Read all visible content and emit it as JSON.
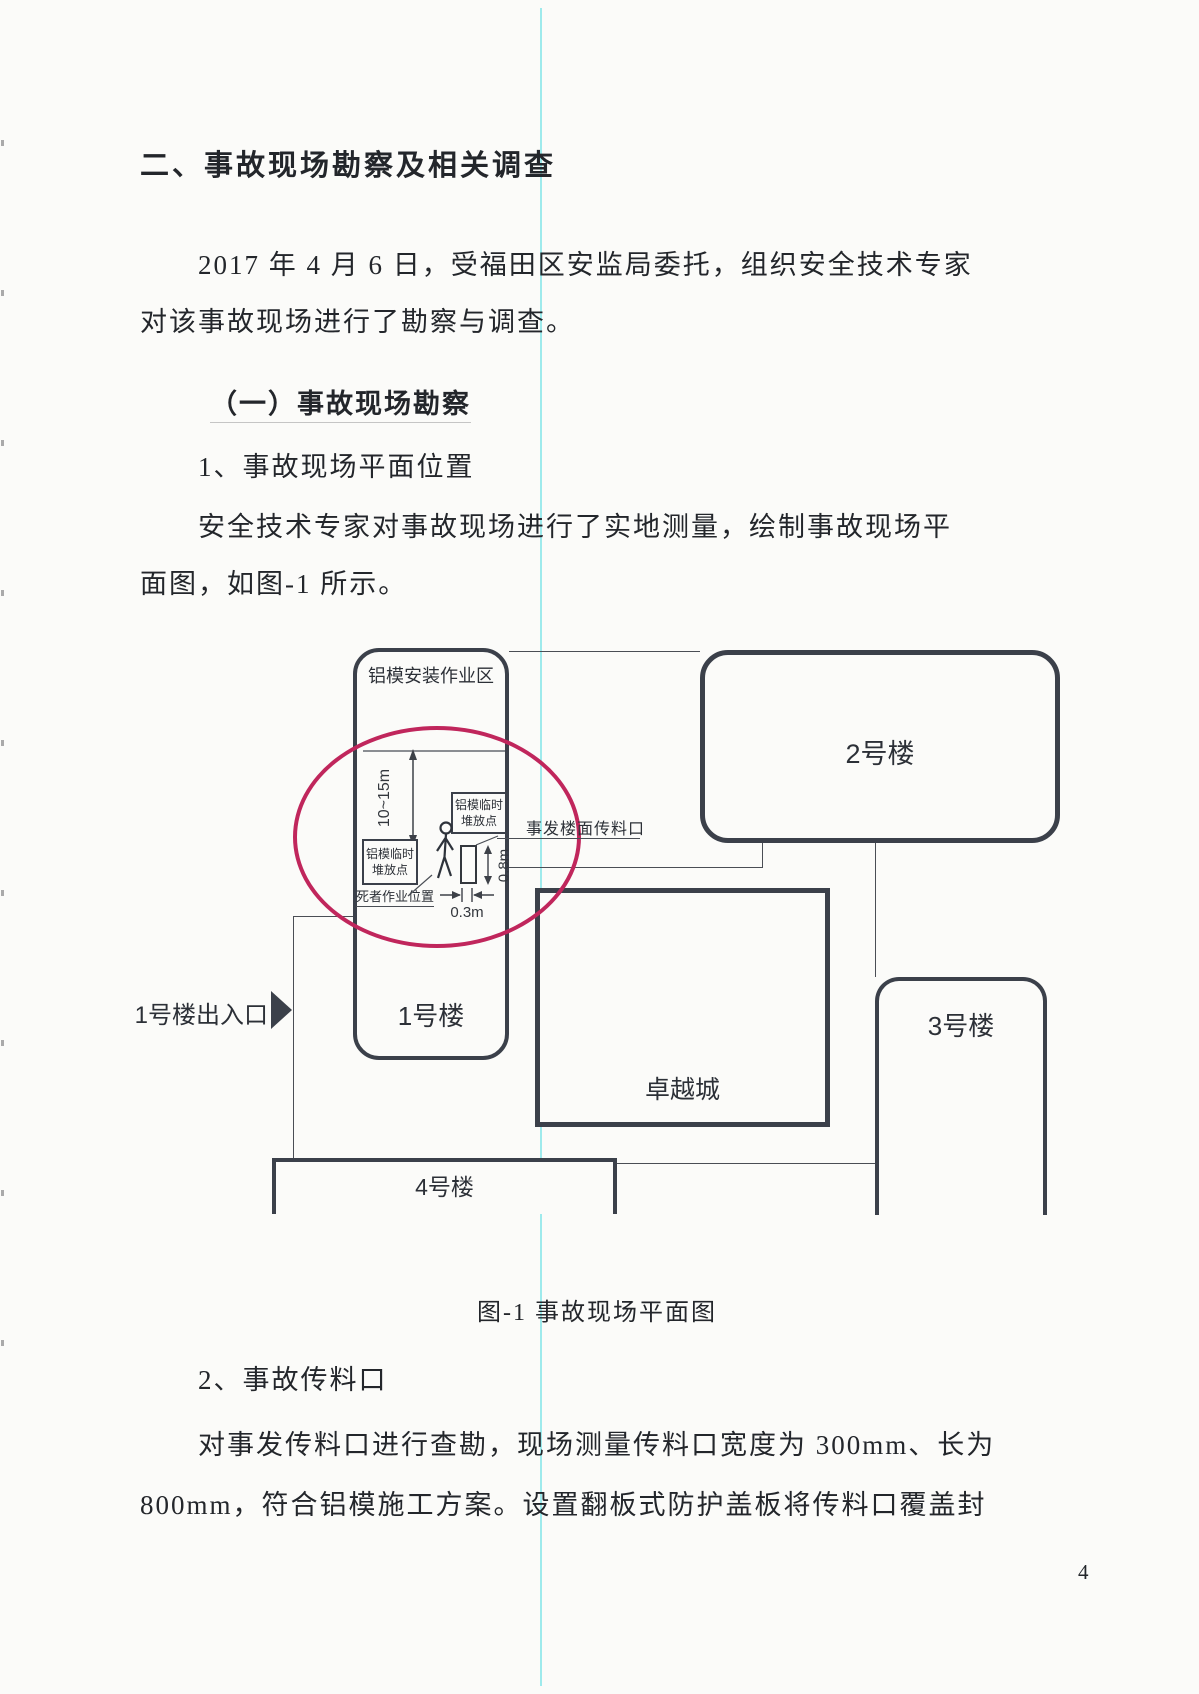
{
  "heading": "二、事故现场勘察及相关调查",
  "paragraphs": {
    "p1_line1": "2017 年 4 月 6 日，受福田区安监局委托，组织安全技术专家",
    "p1_line2": "对该事故现场进行了勘察与调查。",
    "sub1": "（一）事故现场勘察",
    "item1": "1、事故现场平面位置",
    "p2_line1": "安全技术专家对事故现场进行了实地测量，绘制事故现场平",
    "p2_line2": "面图，如图-1 所示。",
    "item2": "2、事故传料口",
    "p3_line1": "对事发传料口进行查勘，现场测量传料口宽度为 300mm、长为",
    "p3_line2": "800mm，符合铝模施工方案。设置翻板式防护盖板将传料口覆盖封"
  },
  "figure": {
    "caption": "图-1 事故现场平面图",
    "labels": {
      "work_area": "铝模安装作业区",
      "building1": "1号楼",
      "building2": "2号楼",
      "building3": "3号楼",
      "building4": "4号楼",
      "zhuoyue": "卓越城",
      "entrance": "1号楼出入口",
      "transfer_opening": "事发楼面传料口",
      "stack_point_line1": "铝模临时",
      "stack_point_line2": "堆放点",
      "victim_position": "死者作业位置",
      "dim_height": "10~15m",
      "dim_width_opening": "0.8m",
      "dim_gap": "0.3m"
    },
    "colors": {
      "highlight_circle": "#c0265c",
      "building_outline": "#3b404a"
    }
  },
  "page": {
    "number": "4"
  },
  "colors": {
    "vertical_rule_cyan": "#8de6ea",
    "ink": "#23262b"
  }
}
